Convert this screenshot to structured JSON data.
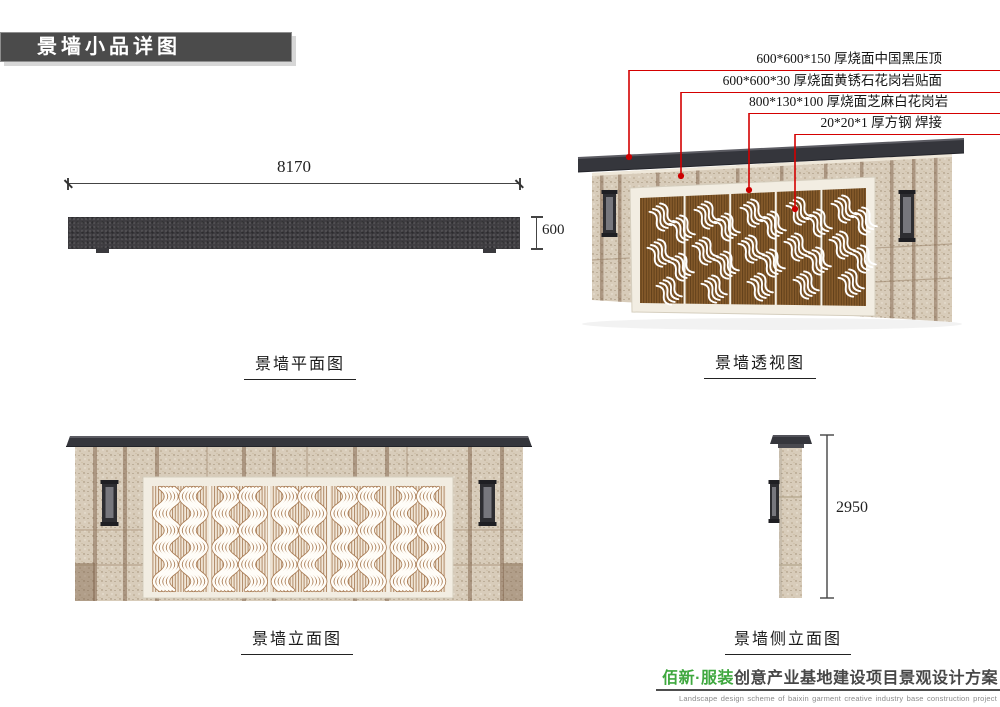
{
  "title_block": {
    "text": "景墙小品详图"
  },
  "callouts": {
    "leader_color": "#d40000",
    "items": [
      {
        "label": "600*600*150 厚烧面中国黑压顶"
      },
      {
        "label": "600*600*30 厚烧面黄锈石花岗岩贴面"
      },
      {
        "label": "800*130*100 厚烧面芝麻白花岗岩"
      },
      {
        "label": "20*20*1 厚方钢 焊接"
      }
    ]
  },
  "views": {
    "plan": {
      "label": "景墙平面图",
      "width_dim": "8170",
      "depth_dim": "600"
    },
    "perspective": {
      "label": "景墙透视图"
    },
    "elevation": {
      "label": "景墙立面图"
    },
    "side": {
      "label": "景墙侧立面图",
      "height_dim": "2950"
    }
  },
  "footer": {
    "brand": "佰新·服装",
    "title": "创意产业基地建设项目景观设计方案",
    "subtitle": "Landscape design scheme of baixin garment creative industry base construction project"
  },
  "colors": {
    "leader_red": "#d40000",
    "brand_green": "#3fa83f",
    "cap_dark": "#35363c",
    "stone_beige": "#d8ccba",
    "stone_strip": "#8d6d55",
    "frame_cream": "#f2ede2",
    "screen_bronze": "#7c5426",
    "screen_slat_light": "#f2e8da"
  }
}
